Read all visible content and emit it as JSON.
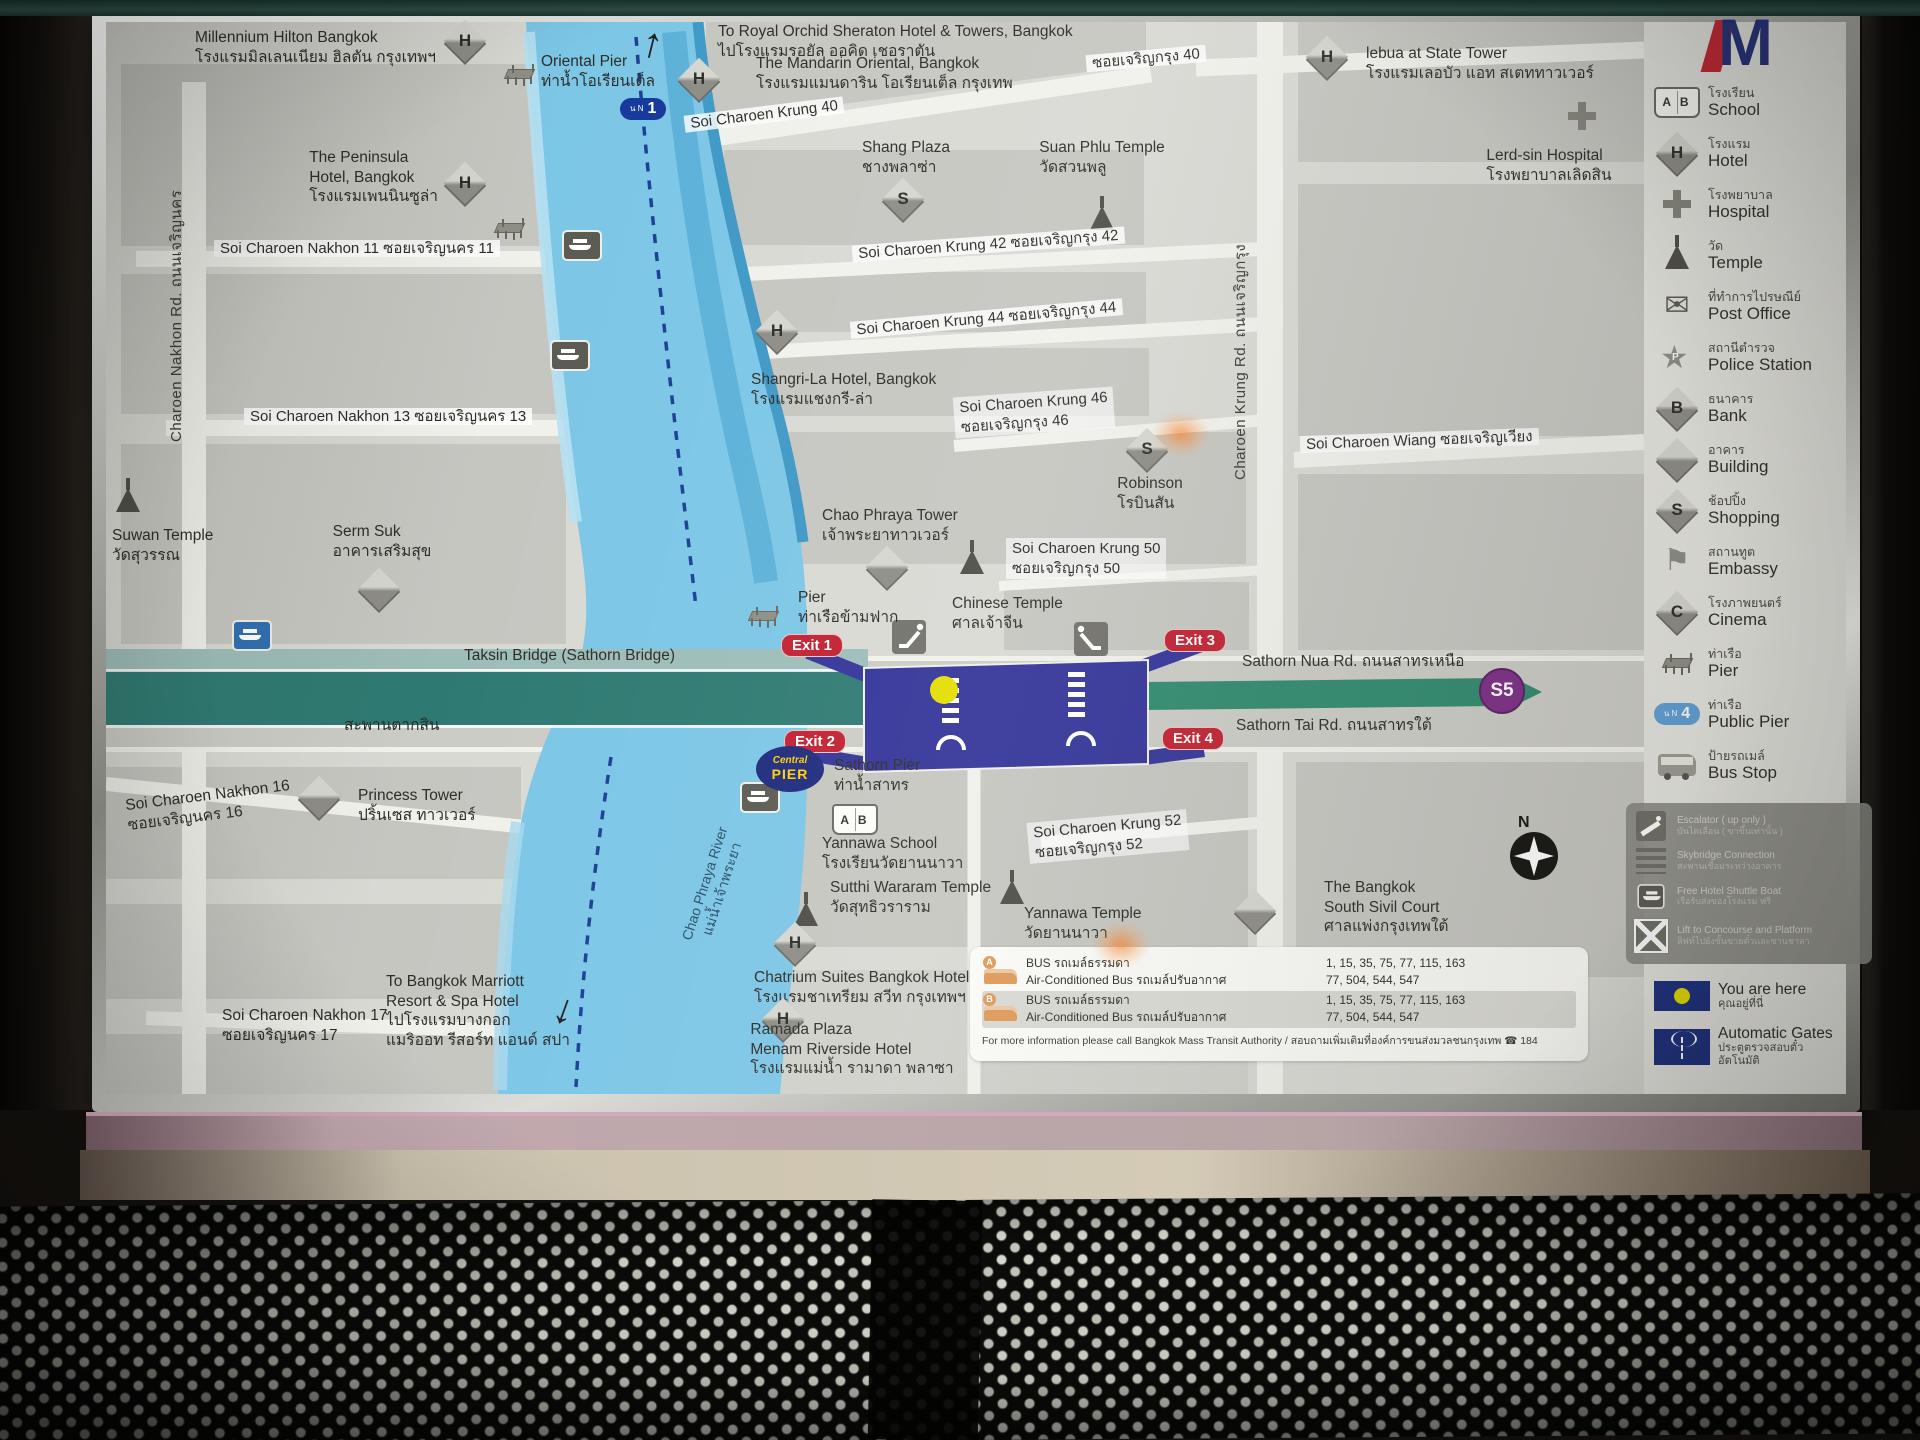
{
  "sign": {
    "logo_letter": "M"
  },
  "map": {
    "labels": [
      {
        "id": "millennium-hilton-hotel-label",
        "kind": "poi",
        "al": "r",
        "x": 330,
        "y": 6,
        "text": "Millennium Hilton Bangkok\nโรงแรมมิลเลนเนียม ฮิลตัน กรุงเทพฯ"
      },
      {
        "id": "hotel-icon",
        "kind": "ic-diamond",
        "letter": "H",
        "x": 344,
        "y": 4
      },
      {
        "id": "pier-icon",
        "kind": "ic-pier",
        "x": 398,
        "y": 42
      },
      {
        "id": "oriental-pier-label",
        "kind": "poi",
        "al": "c",
        "x": 492,
        "y": 30,
        "text": "Oriental Pier\nท่าน้ำโอเรียนเต็ล"
      },
      {
        "id": "north-arrow-icon",
        "kind": "arrow",
        "x": 536,
        "y": 0,
        "rot": 14,
        "text": "↑"
      },
      {
        "id": "pier-badge-n1",
        "kind": "ic-nbadge",
        "x": 514,
        "y": 76,
        "attrs": {
          "pre": "น N",
          "num": "1"
        }
      },
      {
        "id": "royal-orchid-sheraton-label",
        "kind": "poi",
        "x": 612,
        "y": 0,
        "text": "To Royal Orchid Sheraton Hotel & Towers, Bangkok\nไปโรงแรมรอยัล ออคิด เชอราตัน"
      },
      {
        "id": "hotel-icon",
        "kind": "ic-diamond",
        "letter": "H",
        "x": 578,
        "y": 42
      },
      {
        "id": "mandarin-oriental-label",
        "kind": "poi",
        "x": 650,
        "y": 32,
        "text": "The Mandarin Oriental, Bangkok\nโรงแรมแมนดาริน โอเรียนเต็ล กรุงเทพ"
      },
      {
        "id": "soi-charoen-krung-40-label",
        "kind": "road",
        "x": 578,
        "y": 84,
        "rot": -7,
        "text": "Soi Charoen Krung 40"
      },
      {
        "id": "soi-charoen-krung-40-th-label",
        "kind": "road",
        "x": 980,
        "y": 28,
        "rot": -5,
        "text": "ซอยเจริญกรุง 40"
      },
      {
        "id": "shang-plaza-label",
        "kind": "poi",
        "al": "c",
        "x": 800,
        "y": 116,
        "text": "Shang Plaza\nชางพลาซ่า"
      },
      {
        "id": "shopping-icon",
        "kind": "ic-diamond",
        "letter": "S",
        "x": 782,
        "y": 162
      },
      {
        "id": "suan-phlu-temple-label",
        "kind": "poi",
        "al": "c",
        "x": 996,
        "y": 116,
        "text": "Suan Phlu Temple\nวัดสวนพลู"
      },
      {
        "id": "temple-icon",
        "kind": "ic-temple",
        "x": 984,
        "y": 180
      },
      {
        "id": "hotel-icon",
        "kind": "ic-diamond",
        "letter": "H",
        "x": 1206,
        "y": 20
      },
      {
        "id": "lebua-state-tower-label",
        "kind": "poi",
        "x": 1260,
        "y": 22,
        "text": "lebua at State Tower\nโรงแรมเลอบัว แอท สเตททาวเวอร์"
      },
      {
        "id": "hospital-icon",
        "kind": "ic-cross",
        "x": 1462,
        "y": 80
      },
      {
        "id": "lerd-sin-hospital-label",
        "kind": "poi",
        "al": "c",
        "x": 1443,
        "y": 124,
        "text": "Lerd-sin Hospital\nโรงพยาบาลเลิดสิน"
      },
      {
        "id": "peninsula-hotel-label",
        "kind": "poi",
        "al": "r",
        "x": 332,
        "y": 126,
        "text": "The Peninsula\nHotel, Bangkok\nโรงแรมเพนนินซูล่า"
      },
      {
        "id": "hotel-icon",
        "kind": "ic-diamond",
        "letter": "H",
        "x": 344,
        "y": 146
      },
      {
        "id": "pier-icon",
        "kind": "ic-pier",
        "x": 388,
        "y": 196
      },
      {
        "id": "charoen-nakhon-road-label",
        "kind": "vroad",
        "x": 58,
        "y": 420,
        "text": "Charoen Nakhon Rd.   ถนนเจริญนคร"
      },
      {
        "id": "soi-charoen-nakhon-11-label",
        "kind": "road",
        "x": 108,
        "y": 218,
        "text": "Soi Charoen Nakhon 11   ซอยเจริญนคร 11"
      },
      {
        "id": "ferry-pier-icon",
        "kind": "ic-ferry",
        "x": 456,
        "y": 208
      },
      {
        "id": "ferry-pier-icon",
        "kind": "ic-ferry",
        "x": 444,
        "y": 318
      },
      {
        "id": "soi-charoen-krung-42-label",
        "kind": "road",
        "x": 746,
        "y": 214,
        "rot": -4,
        "text": "Soi Charoen Krung 42   ซอยเจริญกรุง 42"
      },
      {
        "id": "soi-charoen-krung-44-label",
        "kind": "road",
        "x": 744,
        "y": 288,
        "rot": -5,
        "text": "Soi Charoen Krung 44   ซอยเจริญกรุง 44"
      },
      {
        "id": "hotel-icon",
        "kind": "ic-diamond",
        "letter": "H",
        "x": 656,
        "y": 294
      },
      {
        "id": "shangri-la-hotel-label",
        "kind": "poi",
        "x": 645,
        "y": 348,
        "text": "Shangri-La Hotel, Bangkok\nโรงแรมแชงกรี-ล่า"
      },
      {
        "id": "soi-charoen-krung-46-label",
        "kind": "roadml",
        "x": 848,
        "y": 370,
        "rot": -4,
        "text": "Soi Charoen Krung 46\nซอยเจริญกรุง 46"
      },
      {
        "id": "soi-charoen-nakhon-13-label",
        "kind": "road",
        "x": 138,
        "y": 386,
        "text": "Soi Charoen Nakhon 13   ซอยเจริญนคร 13"
      },
      {
        "id": "shopping-icon",
        "kind": "ic-diamond",
        "letter": "S",
        "x": 1026,
        "y": 412
      },
      {
        "id": "robinson-label",
        "kind": "poi",
        "al": "c",
        "x": 1044,
        "y": 452,
        "text": "Robinson\nโรบินสัน"
      },
      {
        "id": "soi-charoen-wiang-label",
        "kind": "road",
        "x": 1194,
        "y": 410,
        "rot": -2,
        "text": "Soi Charoen Wiang   ซอยเจริญเวียง"
      },
      {
        "id": "charoen-krung-road-label",
        "kind": "vroad",
        "x": 1122,
        "y": 458,
        "text": "Charoen Krung Rd.   ถนนเจริญกรุง"
      },
      {
        "id": "temple-icon",
        "kind": "ic-temple",
        "x": 10,
        "y": 462
      },
      {
        "id": "suwan-temple-label",
        "kind": "poi",
        "x": 6,
        "y": 504,
        "text": "Suwan Temple\nวัดสุวรรณ"
      },
      {
        "id": "serm-suk-label",
        "kind": "poi",
        "al": "c",
        "x": 276,
        "y": 500,
        "text": "Serm Suk\nอาคารเสริมสุข"
      },
      {
        "id": "building-icon",
        "kind": "ic-diamond",
        "letter": "",
        "x": 258,
        "y": 552
      },
      {
        "id": "pier-sign-icon",
        "kind": "ic-ferry blue",
        "x": 126,
        "y": 598
      },
      {
        "id": "chao-phraya-tower-label",
        "kind": "poi",
        "x": 716,
        "y": 484,
        "text": "Chao Phraya Tower\nเจ้าพระยาทาวเวอร์"
      },
      {
        "id": "building-icon",
        "kind": "ic-diamond",
        "letter": "",
        "x": 766,
        "y": 530
      },
      {
        "id": "soi-charoen-krung-50-label",
        "kind": "roadml",
        "x": 900,
        "y": 516,
        "text": "Soi Charoen Krung 50\nซอยเจริญกรุง 50"
      },
      {
        "id": "pier-icon",
        "kind": "ic-pier",
        "x": 642,
        "y": 584
      },
      {
        "id": "ferry-crossing-pier-label",
        "kind": "poi",
        "x": 692,
        "y": 566,
        "text": "Pier\nท่าเรือข้ามฟาก"
      },
      {
        "id": "temple-icon",
        "kind": "ic-temple",
        "x": 854,
        "y": 524
      },
      {
        "id": "chinese-temple-label",
        "kind": "poi",
        "x": 846,
        "y": 572,
        "text": "Chinese Temple\nศาลเจ้าจีน"
      },
      {
        "id": "taksin-bridge-label",
        "kind": "poi",
        "x": 358,
        "y": 624,
        "text": "Taksin Bridge (Sathorn Bridge)"
      },
      {
        "id": "taksin-bridge-th-label",
        "kind": "poi",
        "x": 238,
        "y": 694,
        "text": "สะพานตากสิน"
      },
      {
        "id": "exit-1-badge",
        "kind": "exit",
        "al": "c",
        "x": 706,
        "y": 612,
        "text": "Exit 1"
      },
      {
        "id": "exit-2-badge",
        "kind": "exit",
        "al": "c",
        "x": 709,
        "y": 708,
        "text": "Exit 2"
      },
      {
        "id": "exit-3-badge",
        "kind": "exit",
        "al": "c",
        "x": 1089,
        "y": 607,
        "text": "Exit 3"
      },
      {
        "id": "exit-4-badge",
        "kind": "exit",
        "al": "c",
        "x": 1087,
        "y": 705,
        "text": "Exit 4"
      },
      {
        "id": "sathorn-nua-road-label",
        "kind": "poi",
        "x": 1136,
        "y": 630,
        "text": "Sathorn Nua Rd. ถนนสาทรเหนือ"
      },
      {
        "id": "sathorn-tai-road-label",
        "kind": "poi",
        "x": 1130,
        "y": 694,
        "text": "Sathorn Tai Rd. ถนนสาทรใต้"
      },
      {
        "id": "line-badge-s5",
        "kind": "s5",
        "al": "c",
        "x": 1396,
        "y": 646,
        "text": "S5"
      },
      {
        "id": "central-pier-badge",
        "kind": "cpier",
        "al": "c",
        "x": 684,
        "y": 724,
        "parts": [
          {
            "cls": "cp1",
            "text": "Central"
          },
          {
            "cls": "cp2",
            "text": "PIER"
          }
        ]
      },
      {
        "id": "sathorn-pier-label",
        "kind": "poi",
        "x": 728,
        "y": 734,
        "text": "Sathorn Pier\nท่าน้ำสาทร"
      },
      {
        "id": "ferry-pier-icon",
        "kind": "ic-ferry",
        "x": 634,
        "y": 760
      },
      {
        "id": "school-icon",
        "kind": "ic-school",
        "x": 726,
        "y": 782
      },
      {
        "id": "yannawa-school-label",
        "kind": "poi",
        "x": 716,
        "y": 812,
        "text": "Yannawa School\nโรงเรียนวัดยานนาวา"
      },
      {
        "id": "temple-icon",
        "kind": "ic-temple",
        "x": 688,
        "y": 876
      },
      {
        "id": "sutthi-wararam-temple-label",
        "kind": "poi",
        "x": 724,
        "y": 856,
        "text": "Sutthi Wararam Temple\nวัดสุทธิวราราม"
      },
      {
        "id": "soi-charoen-krung-52-label",
        "kind": "roadml",
        "x": 922,
        "y": 794,
        "rot": -5,
        "text": "Soi Charoen Krung 52\nซอยเจริญกรุง 52"
      },
      {
        "id": "temple-icon",
        "kind": "ic-temple",
        "x": 894,
        "y": 854
      },
      {
        "id": "yannawa-temple-label",
        "kind": "poi",
        "x": 918,
        "y": 882,
        "text": "Yannawa Temple\nวัดยานนาวา"
      },
      {
        "id": "building-icon",
        "kind": "ic-diamond",
        "letter": "",
        "x": 198,
        "y": 760
      },
      {
        "id": "princess-tower-label",
        "kind": "poi",
        "x": 252,
        "y": 764,
        "text": "Princess Tower\nปริ้นเซส ทาวเวอร์"
      },
      {
        "id": "soi-charoen-nakhon-16-label",
        "kind": "poi",
        "x": 20,
        "y": 764,
        "rot": -7,
        "text": "Soi Charoen Nakhon 16\nซอยเจริญนคร 16"
      },
      {
        "id": "soi-charoen-nakhon-17-label",
        "kind": "poi",
        "x": 116,
        "y": 984,
        "text": "Soi Charoen Nakhon 17\nซอยเจริญนคร 17"
      },
      {
        "id": "bangkok-marriott-label",
        "kind": "poi",
        "al": "c",
        "x": 372,
        "y": 950,
        "text": "To Bangkok Marriott\nResort & Spa Hotel\nไปโรงแรมบางกอก\nแมริออท รีสอร์ท แอนด์ สปา"
      },
      {
        "id": "south-arrow-icon",
        "kind": "arrow",
        "x": 448,
        "y": 966,
        "rot": 20,
        "text": "↓"
      },
      {
        "id": "hotel-icon",
        "kind": "ic-diamond",
        "letter": "H",
        "x": 674,
        "y": 906
      },
      {
        "id": "chatrium-suites-label",
        "kind": "poi",
        "x": 648,
        "y": 946,
        "text": "Chatrium Suites Bangkok Hotel\nโรงแรมชาเทรียม สวีท กรุงเทพฯ"
      },
      {
        "id": "hotel-icon",
        "kind": "ic-diamond",
        "letter": "H",
        "x": 662,
        "y": 982
      },
      {
        "id": "ramada-plaza-label",
        "kind": "poi",
        "al": "c",
        "x": 746,
        "y": 998,
        "text": "Ramada Plaza\nMenam Riverside Hotel\nโรงแรมแม่น้ำ รามาดา พลาซา"
      },
      {
        "id": "south-civil-court-label",
        "kind": "poi",
        "x": 1218,
        "y": 856,
        "text": "The Bangkok\nSouth Sivil Court\nศาลแพ่งกรุงเทพใต้"
      },
      {
        "id": "building-icon",
        "kind": "ic-diamond",
        "letter": "",
        "x": 1134,
        "y": 874
      },
      {
        "id": "compass-rose",
        "kind": "compass",
        "x": 1398,
        "y": 794,
        "parts": [
          {
            "cls": "cn",
            "text": "N"
          },
          {
            "cls": "cstar",
            "text": ""
          }
        ]
      },
      {
        "id": "chao-phraya-river-label",
        "kind": "rvr",
        "x": 548,
        "y": 846,
        "rot": -72,
        "text": "Chao Phraya River\nแม่น้ำเจ้าพระยา"
      },
      {
        "id": "reflection-glare",
        "kind": "glare",
        "x": 1046,
        "y": 390
      },
      {
        "id": "reflection-glare",
        "kind": "glare",
        "x": 986,
        "y": 900
      }
    ]
  },
  "legend": {
    "items": [
      {
        "icon": "school",
        "th": "โรงเรียน",
        "en": "School"
      },
      {
        "icon": "hotel",
        "th": "โรงแรม",
        "en": "Hotel"
      },
      {
        "icon": "hospital",
        "th": "โรงพยาบาล",
        "en": "Hospital"
      },
      {
        "icon": "temple",
        "th": "วัด",
        "en": "Temple"
      },
      {
        "icon": "postoffice",
        "th": "ที่ทำการไปรษณีย์",
        "en": "Post Office"
      },
      {
        "icon": "police",
        "th": "สถานีตำรวจ",
        "en": "Police Station"
      },
      {
        "icon": "bank",
        "th": "ธนาคาร",
        "en": "Bank"
      },
      {
        "icon": "building",
        "th": "อาคาร",
        "en": "Building"
      },
      {
        "icon": "shopping",
        "th": "ช้อปปิ้ง",
        "en": "Shopping"
      },
      {
        "icon": "embassy",
        "th": "สถานทูต",
        "en": "Embassy"
      },
      {
        "icon": "cinema",
        "th": "โรงภาพยนตร์",
        "en": "Cinema"
      },
      {
        "icon": "pier",
        "th": "ท่าเรือ",
        "en": "Pier"
      },
      {
        "icon": "publicpier",
        "th": "ท่าเรือ",
        "en": "Public Pier",
        "badge_pre": "น N",
        "badge_num": "4"
      },
      {
        "icon": "busstop",
        "th": "ป้ายรถเมล์",
        "en": "Bus Stop"
      }
    ],
    "info_items": [
      {
        "icon": "escalator",
        "en": "Escalator ( up only )",
        "th": "บันไดเลื่อน ( ขาขึ้นเท่านั้น )"
      },
      {
        "icon": "skybridge",
        "en": "Skybridge Connection",
        "th": "สะพานเชื่อมระหว่างอาคาร"
      },
      {
        "icon": "shuttleboat",
        "en": "Free Hotel Shuttle Boat",
        "th": "เรือรับส่งของโรงแรม ฟรี"
      },
      {
        "icon": "lift",
        "en": "Lift to Concourse and Platform",
        "th": "ลิฟท์ไปยังชั้นขายตั๋วและชานชาลา"
      }
    ],
    "you_are_here": {
      "en": "You are here",
      "th": "คุณอยู่ที่นี่"
    },
    "automatic_gates": {
      "en": "Automatic Gates",
      "th": "ประตูตรวจสอบตั๋วอัตโนมัติ"
    }
  },
  "bus_info": {
    "rows": [
      {
        "stop": "A",
        "bus_label": "BUS",
        "bus_label_th": "รถเมล์ธรรมดา",
        "bus_routes": "1, 15, 35, 75, 77, 115, 163",
        "ac_label": "Air-Conditioned Bus",
        "ac_label_th": "รถเมล์ปรับอากาศ",
        "ac_routes": "77, 504, 544, 547"
      },
      {
        "stop": "B",
        "bus_label": "BUS",
        "bus_label_th": "รถเมล์ธรรมดา",
        "bus_routes": "1, 15, 35, 75, 77, 115, 163",
        "ac_label": "Air-Conditioned Bus",
        "ac_label_th": "รถเมล์ปรับอากาศ",
        "ac_routes": "77, 504, 544, 547"
      }
    ],
    "footer": "For more information please call Bangkok Mass Transit Authority / สอบถามเพิ่มเติมที่องค์การขนส่งมวลชนกรุงเทพ ☎ 184"
  },
  "colors": {
    "river": "#7cc6e6",
    "station_navy": "#333399",
    "exit_red": "#c12030",
    "line_green": "#2f8a6e",
    "s5_purple": "#7c2e85",
    "you_are_here_dot": "#e4de00",
    "badge_navy": "#1c2f7e",
    "bridge_teal": "#2e7a72"
  }
}
